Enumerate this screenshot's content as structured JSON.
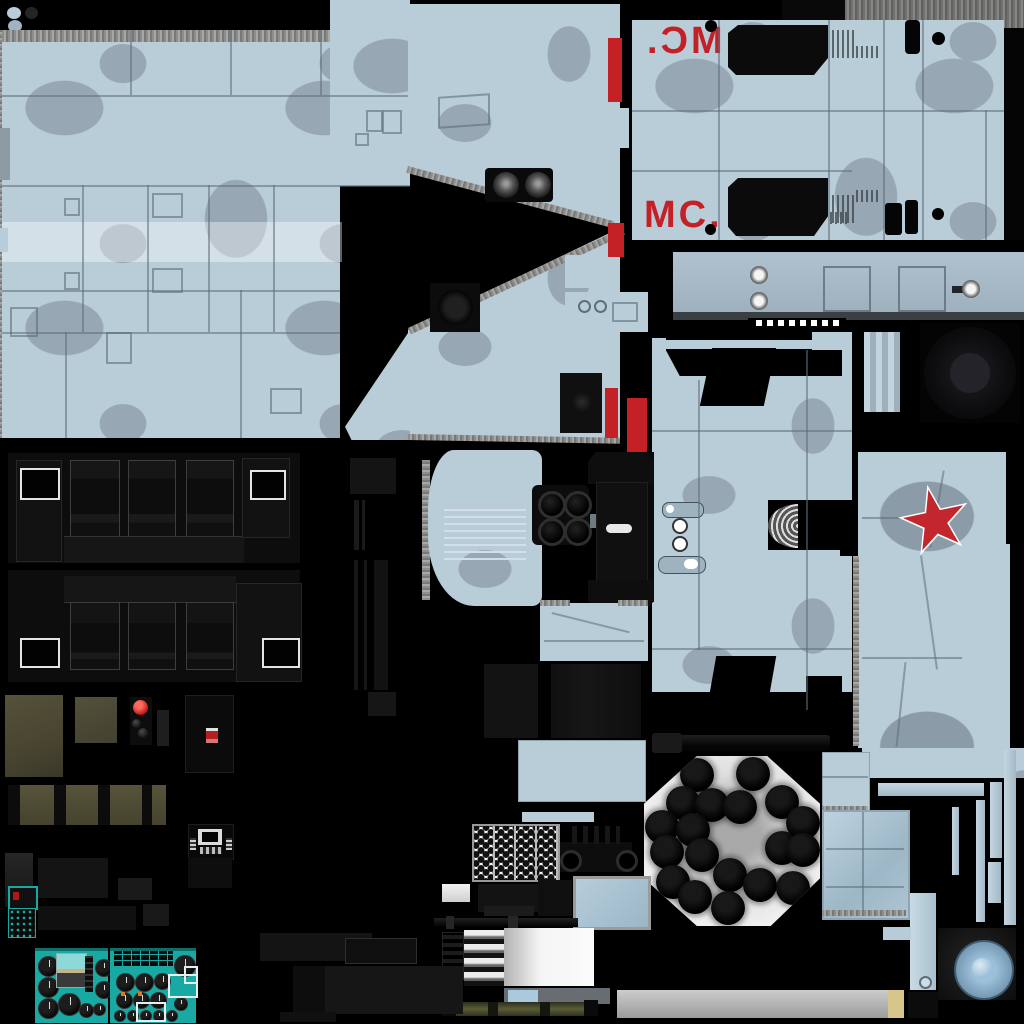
{
  "colors": {
    "camo_base": "#b9cdd9",
    "camo_blob": "#97a7b3",
    "camo_light_band": "#cddde7",
    "panel_line": "#5d6e7a",
    "marking_red": "#c42127",
    "star_red": "#c1272d",
    "star_outline": "#ffffff",
    "teal": "#17a9a2",
    "olive": "#4e4b33",
    "metal_grey": "#9b9b99",
    "rivet_panel": "#a6b9c6",
    "glass_blue": "#a9c3d4",
    "knob_blue": "#9cc0d8",
    "tan": "#d6c68c",
    "near_black": "#0a0a0a"
  },
  "markings": {
    "code_top_mirrored": "MC.",
    "code_bottom": "MC."
  },
  "swatches": [
    {
      "name": "camo-light-blue",
      "color": "#b9cdd9"
    },
    {
      "name": "near-black",
      "color": "#222426"
    },
    {
      "name": "camo-blue-grey",
      "color": "#9fb4c0"
    }
  ],
  "rocket_pod": {
    "tube_count": 19,
    "tube_diameter": 34,
    "tubes": [
      [
        53,
        19
      ],
      [
        109,
        18
      ],
      [
        39,
        47
      ],
      [
        68,
        49
      ],
      [
        96,
        51
      ],
      [
        138,
        46
      ],
      [
        18,
        71
      ],
      [
        49,
        74
      ],
      [
        159,
        67
      ],
      [
        23,
        96
      ],
      [
        58,
        99
      ],
      [
        138,
        92
      ],
      [
        159,
        94
      ],
      [
        29,
        126
      ],
      [
        86,
        119
      ],
      [
        116,
        129
      ],
      [
        149,
        132
      ],
      [
        51,
        141
      ],
      [
        84,
        152
      ]
    ]
  },
  "instrument_panels": {
    "left": {
      "gauges": [
        [
          3,
          5,
          19
        ],
        [
          3,
          26,
          19
        ],
        [
          3,
          47,
          19
        ],
        [
          60,
          8,
          16
        ],
        [
          60,
          30,
          16
        ],
        [
          23,
          42,
          21
        ],
        [
          44,
          52,
          13
        ],
        [
          58,
          52,
          11
        ]
      ]
    },
    "right": {
      "gauges": [
        [
          6,
          22,
          17
        ],
        [
          25,
          22,
          17
        ],
        [
          44,
          22,
          15
        ],
        [
          6,
          41,
          15
        ],
        [
          23,
          41,
          15
        ],
        [
          40,
          41,
          15
        ],
        [
          64,
          4,
          20
        ],
        [
          64,
          46,
          12
        ],
        [
          4,
          59,
          10
        ],
        [
          17,
          59,
          10
        ],
        [
          30,
          59,
          10
        ],
        [
          43,
          59,
          10
        ],
        [
          56,
          59,
          10
        ]
      ]
    }
  }
}
